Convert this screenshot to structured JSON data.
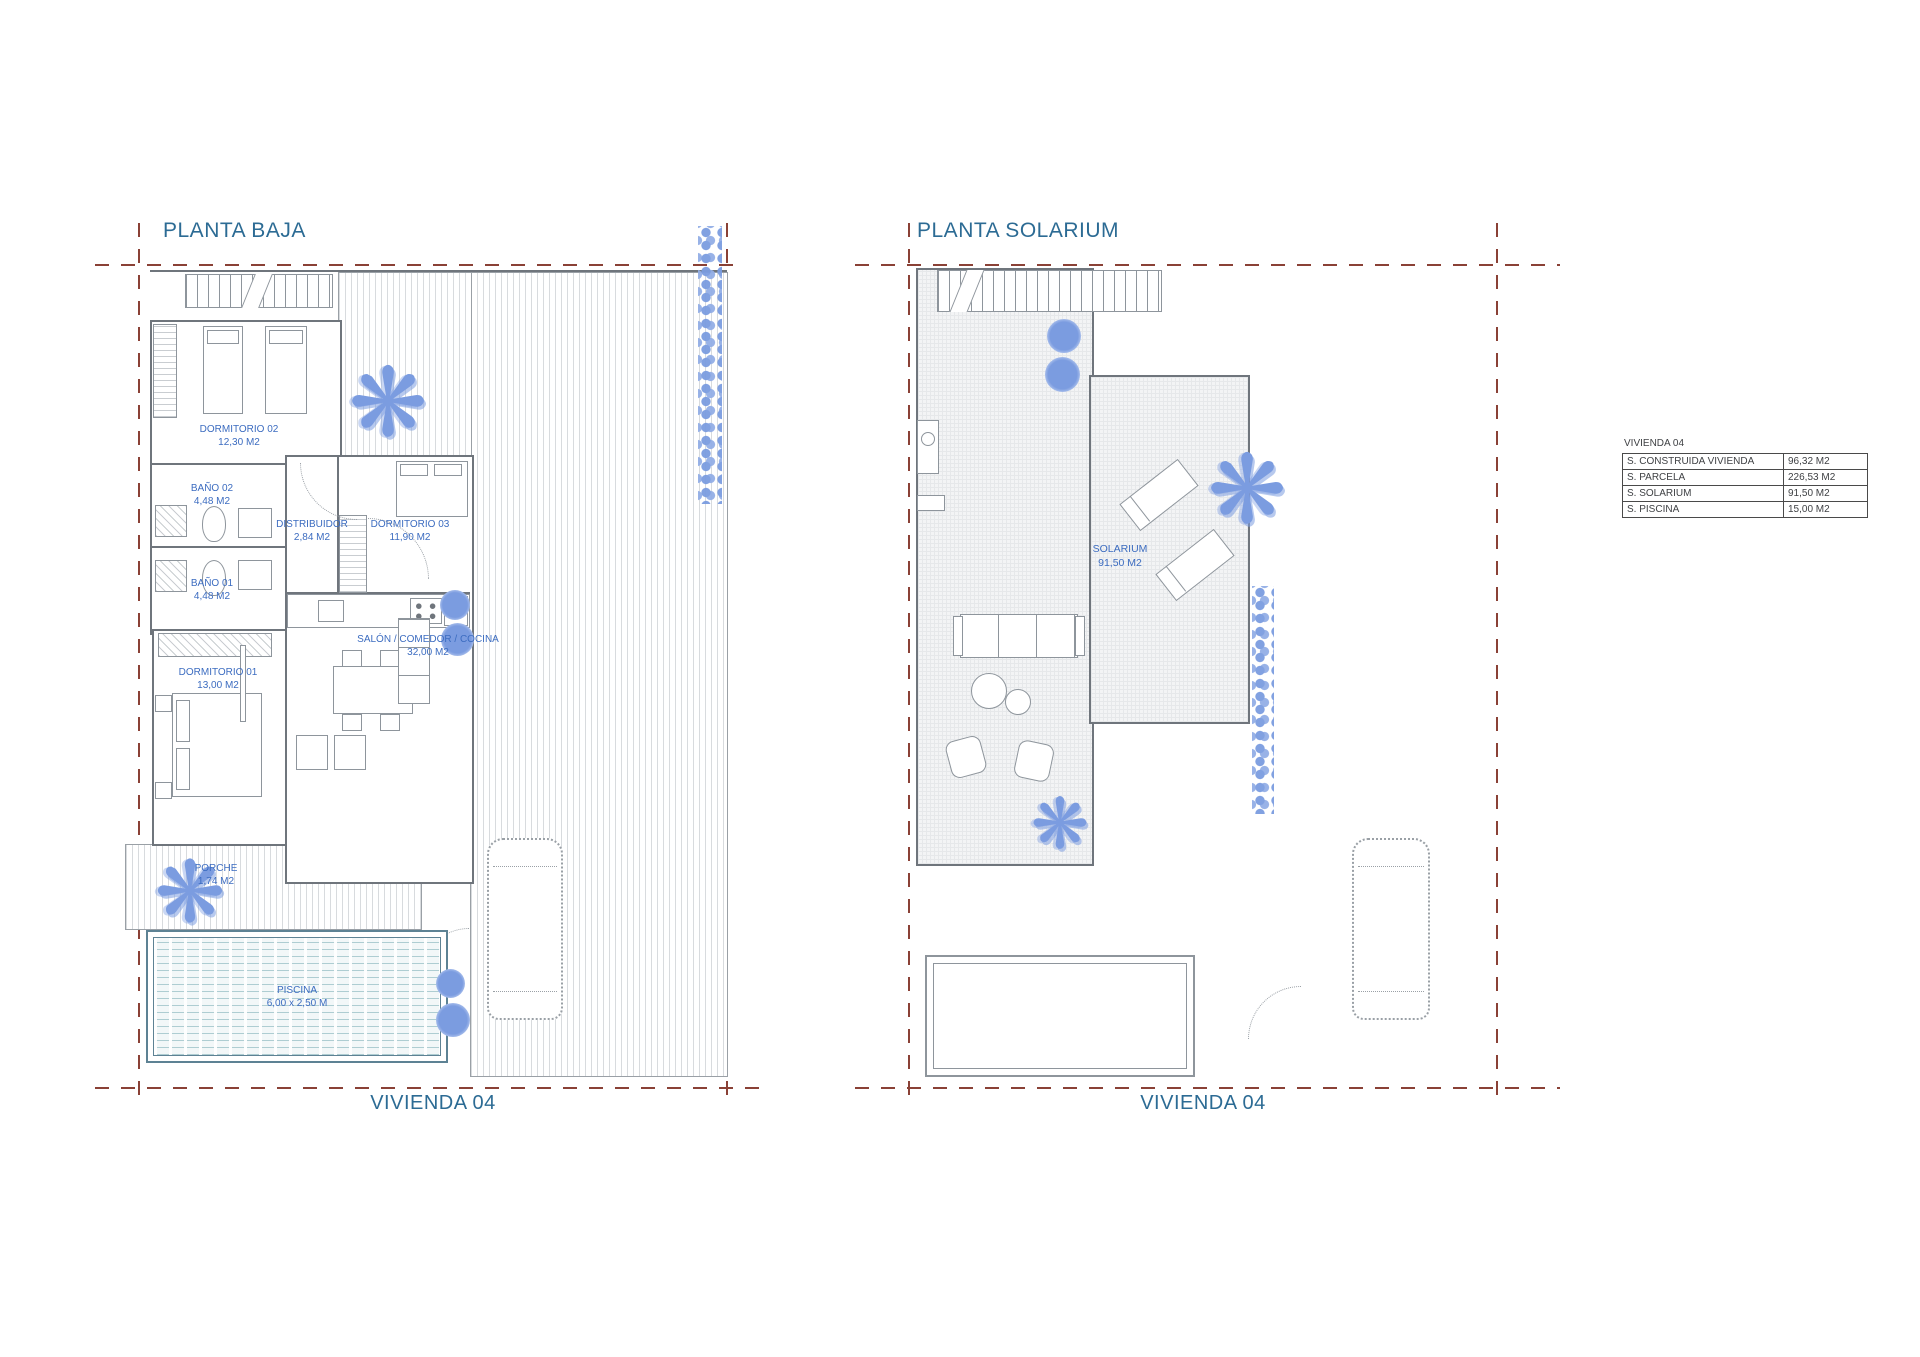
{
  "colors": {
    "title_blue": "#2c6b94",
    "room_label_blue": "#3c6cc0",
    "boundary_red": "#8a4136",
    "plan_gray": "#8e959c",
    "plant_blue": "#7b9ce0"
  },
  "icons": {
    "palm": "❋"
  },
  "plan_baja": {
    "title": "PLANTA BAJA",
    "footer": "VIVIENDA 04",
    "rooms": {
      "dormitorio_02": {
        "name": "DORMITORIO 02",
        "area": "12,30 M2"
      },
      "bano_02": {
        "name": "BAÑO 02",
        "area": "4,48 M2"
      },
      "distribuidor": {
        "name": "DISTRIBUIDOR",
        "area": "2,84 M2"
      },
      "dormitorio_03": {
        "name": "DORMITORIO 03",
        "area": "11,90 M2"
      },
      "bano_01": {
        "name": "BAÑO 01",
        "area": "4,48 M2"
      },
      "salon": {
        "name": "SALÓN / COMEDOR / COCINA",
        "area": "32,00 M2"
      },
      "dormitorio_01": {
        "name": "DORMITORIO 01",
        "area": "13,00 M2"
      },
      "porche": {
        "name": "PORCHE",
        "area": "1,74 M2"
      },
      "piscina": {
        "name": "PISCINA",
        "area": "6,00 x 2,50 M"
      }
    }
  },
  "plan_solarium": {
    "title": "PLANTA SOLARIUM",
    "footer": "VIVIENDA 04",
    "rooms": {
      "solarium": {
        "name": "SOLARIUM",
        "area": "91,50 M2"
      }
    }
  },
  "summary_table": {
    "title": "VIVIENDA 04",
    "rows": [
      {
        "label": "S. CONSTRUIDA VIVIENDA",
        "value": "96,32 M2"
      },
      {
        "label": "S. PARCELA",
        "value": "226,53 M2"
      },
      {
        "label": "S. SOLARIUM",
        "value": "91,50 M2"
      },
      {
        "label": "S. PISCINA",
        "value": "15,00 M2"
      }
    ]
  }
}
